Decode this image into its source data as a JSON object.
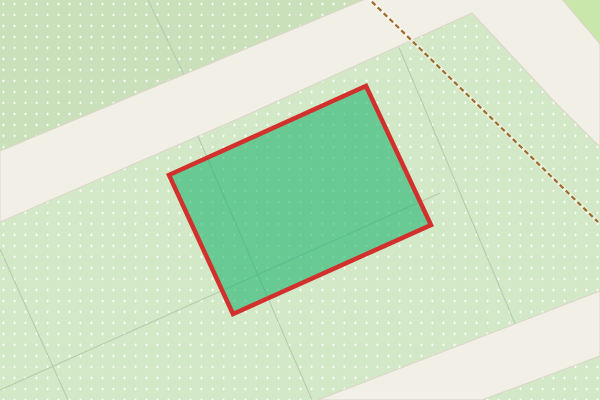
{
  "map": {
    "canvas": {
      "width": 600,
      "height": 400
    },
    "base": {
      "name": "nursery-field",
      "fill": "#d3e8c7"
    },
    "dots": {
      "color": "#ffffff",
      "opacity": 0.8,
      "spacing": 11
    },
    "regions": [
      {
        "name": "upper-left-field",
        "fill": "#c9e0ba",
        "dotted": true,
        "points": "0,0 368,0 0,151"
      },
      {
        "name": "top-right-grass",
        "fill": "#c9e7ab",
        "dotted": false,
        "points": "561,0 600,0 600,45"
      }
    ],
    "boundary_lines": {
      "color": "#b6cbad",
      "width": 1.1,
      "segments": [
        [
          148,
          0,
          189,
          85
        ],
        [
          197,
          134,
          312,
          400
        ],
        [
          0,
          249,
          68,
          400
        ],
        [
          398,
          45,
          516,
          326
        ],
        [
          0,
          390,
          440,
          193
        ]
      ]
    },
    "roads": {
      "fill": "#f2efe7",
      "casing": "#dbd5c7",
      "casing_width": 1,
      "items": [
        {
          "name": "road-upper",
          "points": "0,151 368,-2 462,-52 561,-2 600,44 600,147 553,100 472,13 240,118 0,222"
        },
        {
          "name": "road-lower",
          "points": "318,400 600,291 600,356 482,400"
        }
      ]
    },
    "track": {
      "name": "track-path",
      "color": "#9b6c2e",
      "halo": "rgba(255,252,240,0.45)",
      "width": 2.2,
      "halo_width": 4.2,
      "dash": "5 3.2",
      "x1": 366,
      "y1": -4,
      "x2": 598,
      "y2": 222
    },
    "selected_parcel": {
      "name": "selected-parcel",
      "fill": "rgba(26,180,110,0.58)",
      "stroke": "#d1302d",
      "stroke_width": 4.5,
      "points": "169,175 366,86 431,225 233,314"
    }
  }
}
